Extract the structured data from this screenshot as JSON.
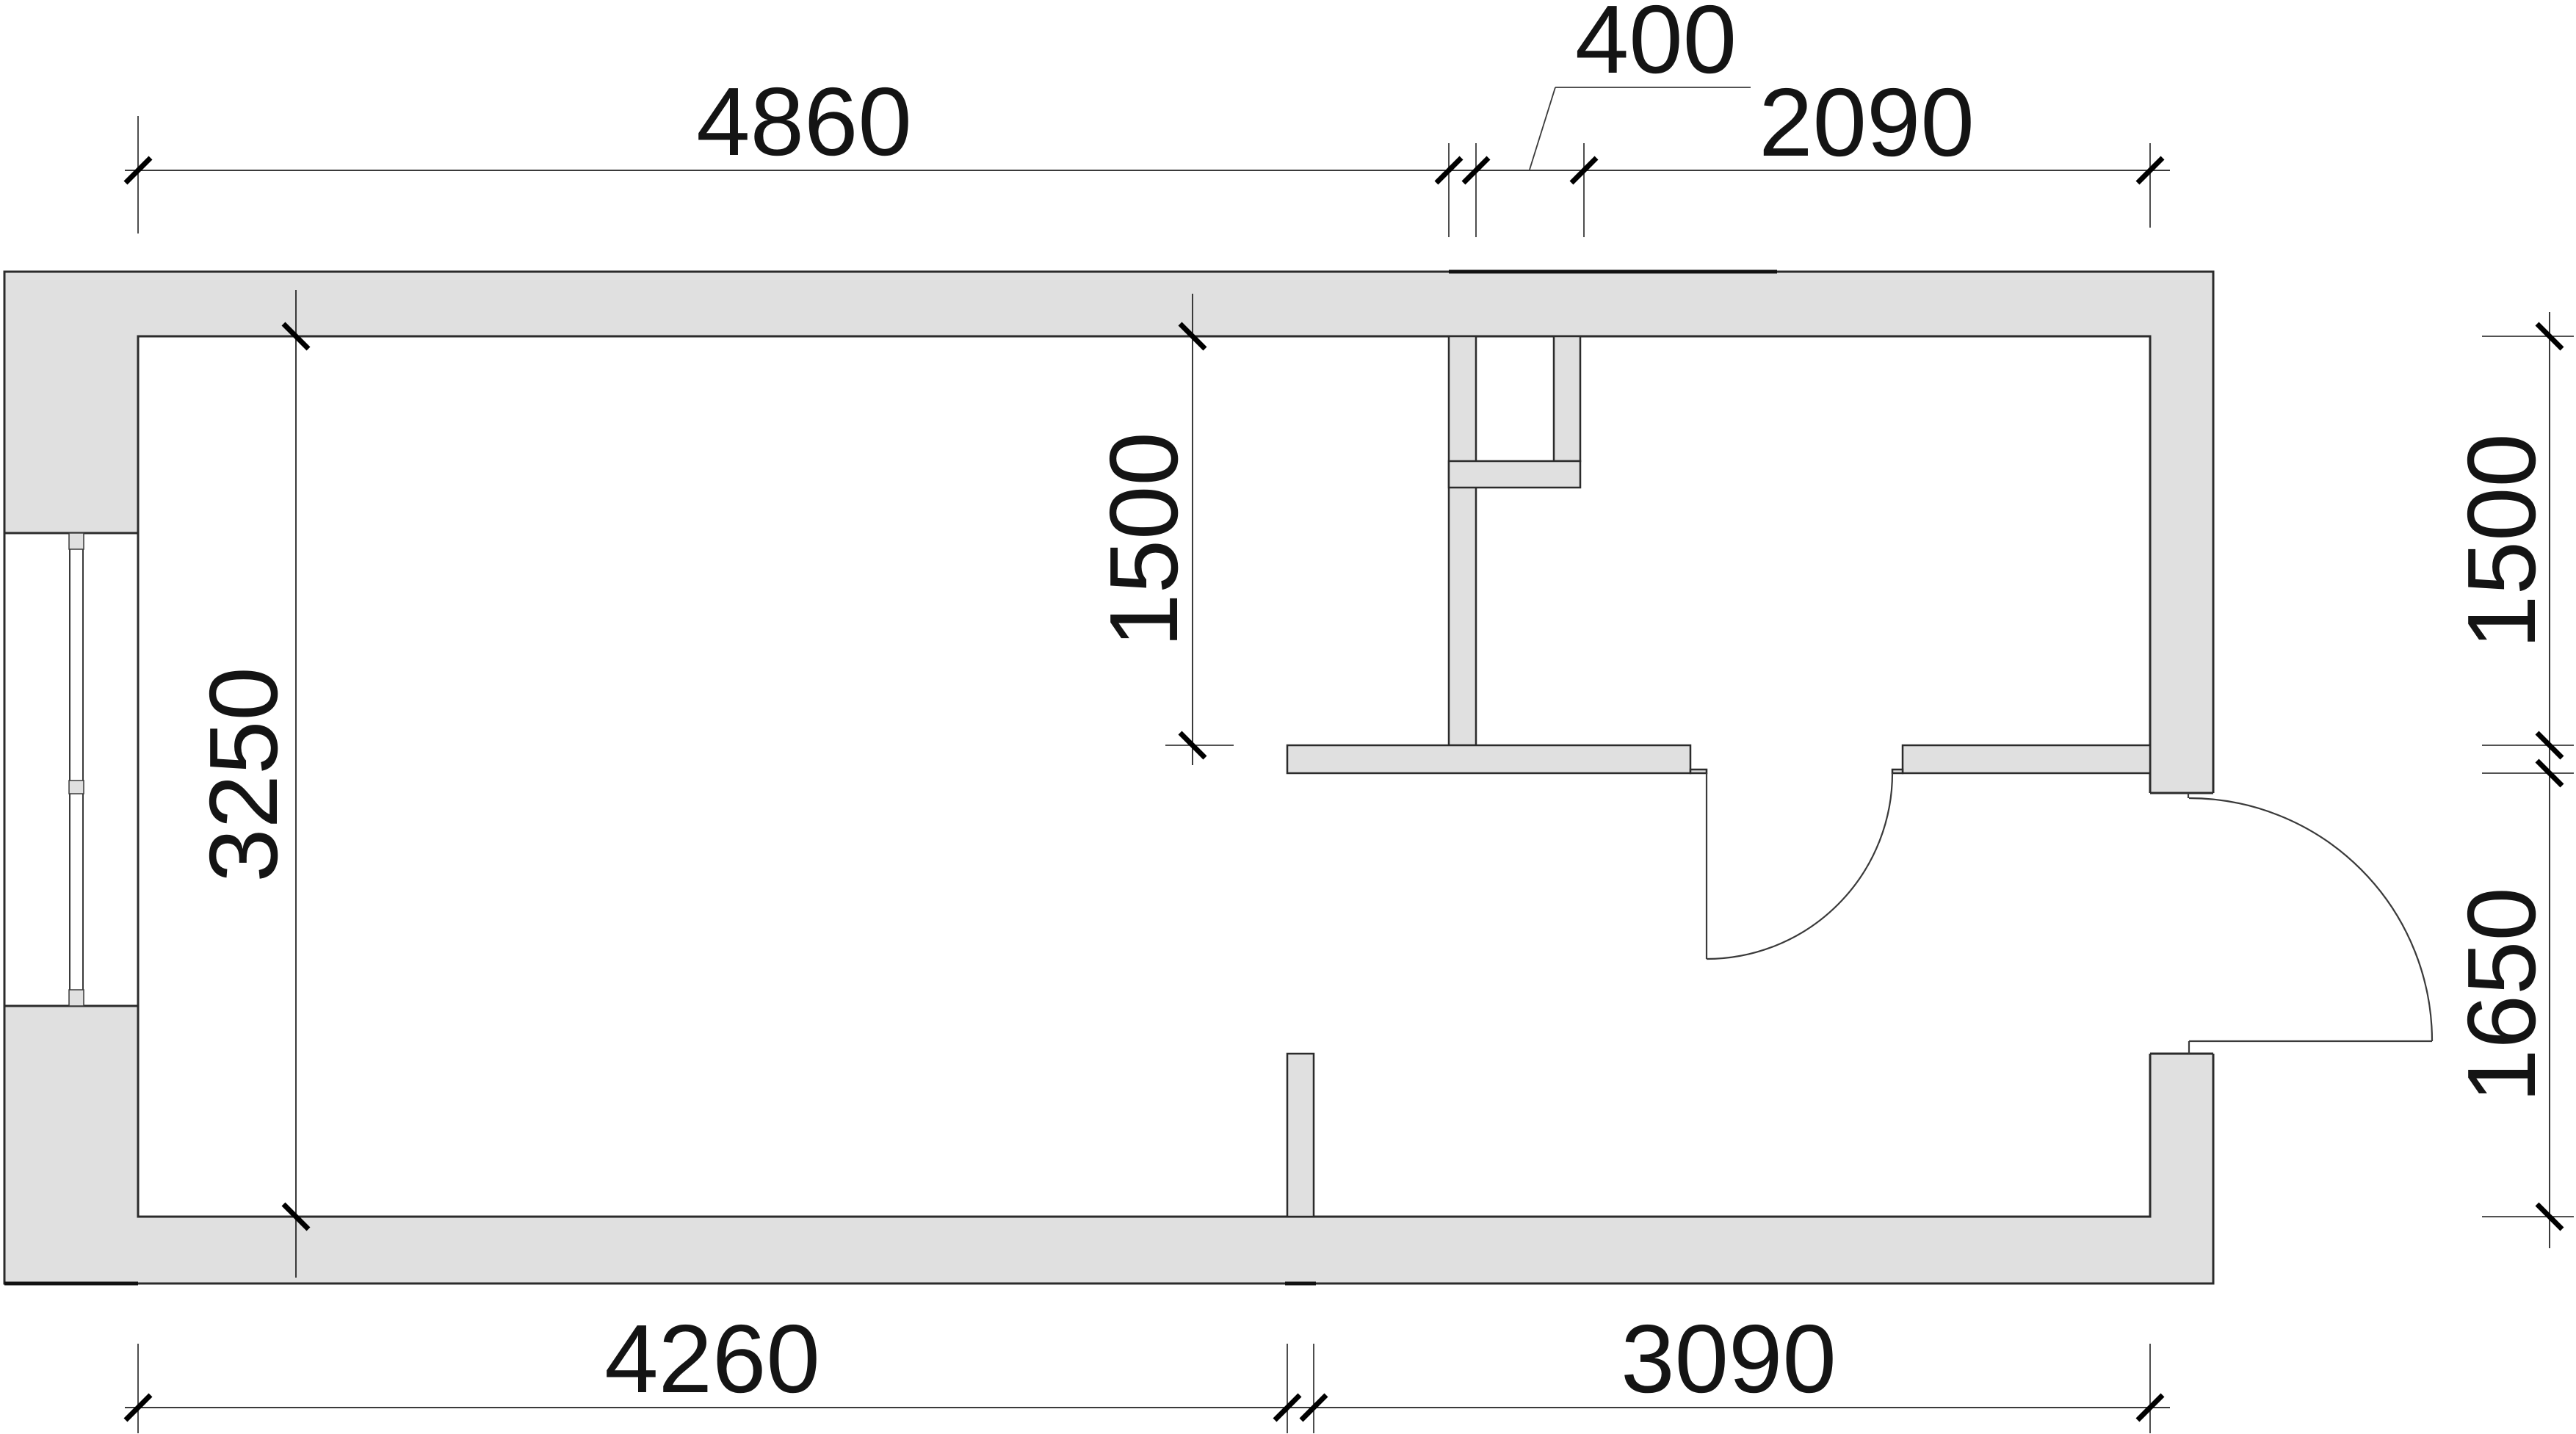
{
  "drawing": {
    "title": "apartment floor plan",
    "units": "mm",
    "wall_fill_color": "#e0e0e0",
    "line_color": "#2b2b2b",
    "dims": {
      "top_main": "4860",
      "top_small": "400",
      "top_right": "2090",
      "left_height": "3250",
      "mid_height": "1500",
      "right_upper": "1500",
      "right_lower": "1650",
      "bottom_left": "4260",
      "bottom_right": "3090"
    }
  }
}
